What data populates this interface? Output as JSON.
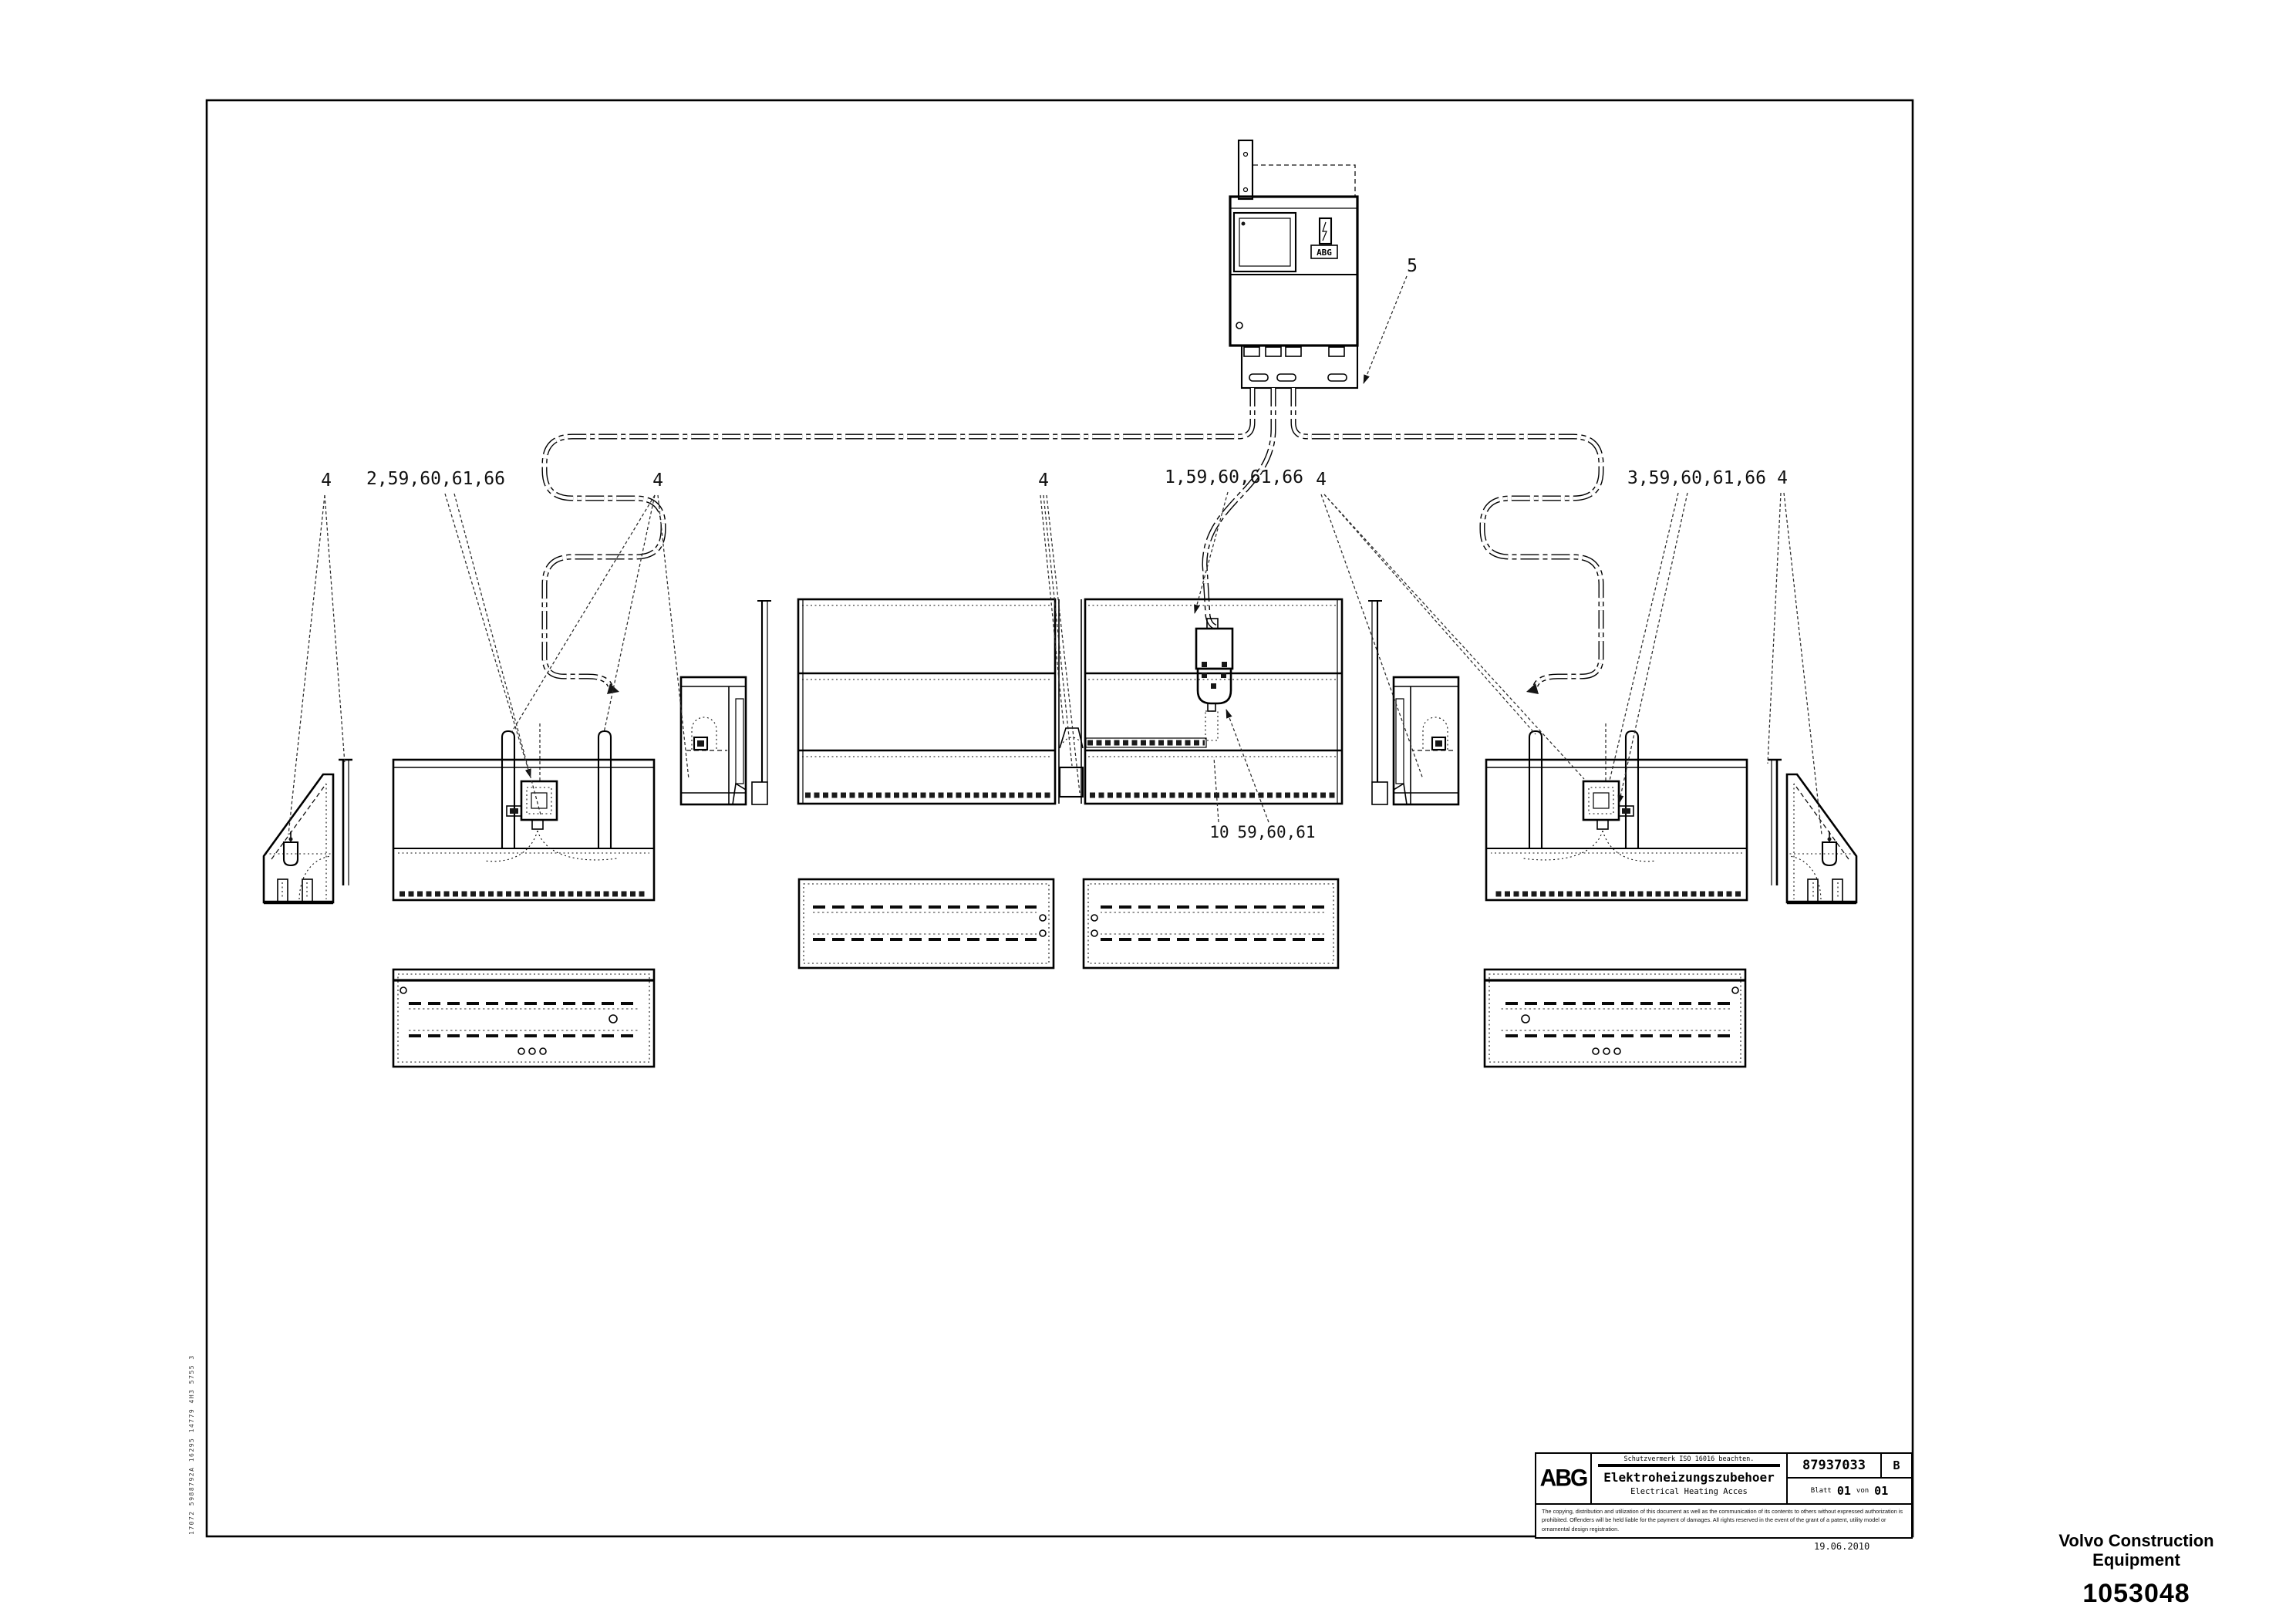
{
  "drawing_labels": {
    "callout_gate_left": "4",
    "callout_ext_left": "2,59,60,61,66",
    "callout_section_left": "4",
    "callout_tamper": "4",
    "callout_center_box": "1,59,60,61,66",
    "callout_section_right": "4",
    "callout_ext_right": "3,59,60,61,66",
    "callout_gate_right": "4",
    "callout_control_box": "5",
    "callout_floor": "10",
    "callout_heaters": "59,60,61",
    "control_box_badge": "ABG"
  },
  "title_block": {
    "logo": "ABG",
    "protection_note": "Schutzvermerk ISO 16016 beachten.",
    "title_line1": "Elektroheizungszubehoer",
    "title_line2": "Electrical Heating Acces",
    "drawing_number": "87937033",
    "revision": "B",
    "sheet_word": "Blatt",
    "sheet_number": "01",
    "of_word": "von",
    "of_total": "01",
    "legal_line1": "The copying, distribution and utilization of this document as well as the communication of its contents to others without expressed authorization is",
    "legal_line2": "prohibited. Offenders will be held liable for the payment of damages. All rights reserved in the event of the grant of a patent, utility model or",
    "legal_line3": "ornamental design registration.",
    "print_date": "19.06.2010"
  },
  "footer": {
    "company_line1": "Volvo Construction",
    "company_line2": "Equipment",
    "document_number": "1053048"
  },
  "side_stamp": "17072 5988792A 16295 14779 4H3 5755 3"
}
